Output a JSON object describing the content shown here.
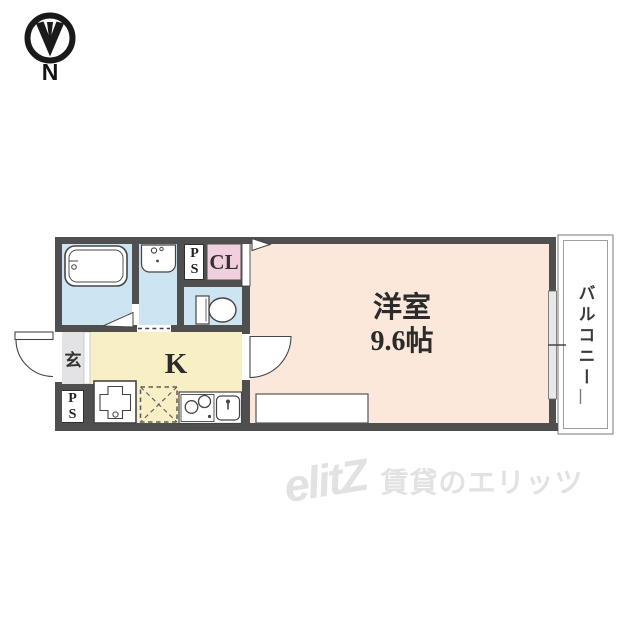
{
  "compass": {
    "label": "N"
  },
  "floorplan": {
    "rooms": {
      "main_room": {
        "name": "洋室",
        "size": "9.6帖"
      },
      "kitchen": {
        "label": "K"
      },
      "closet": {
        "label": "CL"
      },
      "entrance": {
        "label": "玄"
      },
      "pipe_space_top": {
        "label": "PS"
      },
      "pipe_space_bottom": {
        "label": "PS"
      },
      "balcony": {
        "label": "バルコニー"
      }
    },
    "colors": {
      "wall": "#4f4f4f",
      "wet_area_blue": "#cde4f2",
      "kitchen_yellow": "#f8efc5",
      "main_room_peach": "#fbe8da",
      "closet_pink": "#f2cfdf",
      "entrance_gray": "#e3e3e5"
    }
  },
  "watermark": {
    "logo": "elitZ",
    "text": "賃貸のエリッツ"
  }
}
